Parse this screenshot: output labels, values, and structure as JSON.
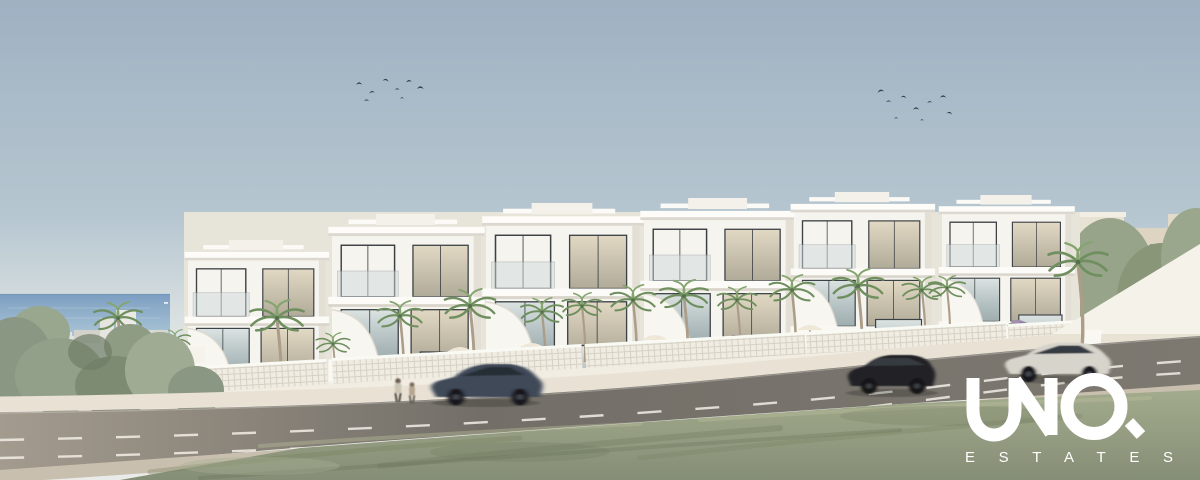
{
  "logo": {
    "brand": "UNIQ",
    "tagline": "ESTATES",
    "color": "#ffffff"
  },
  "palette": {
    "sky_top": "#9fb1c2",
    "sky_horizon": "#e9ebe8",
    "sea": "#7c9ec1",
    "building_white": "#f6f4ef",
    "facade_shadow": "#e3dfd5",
    "glass": "#b9c5c6",
    "fence_lattice": "#f0ece2",
    "road": "#75716a",
    "road_marking": "#f2efe7",
    "sidewalk": "#e9e2d4",
    "grass": "#97a083",
    "tree_green": "#8e9c82",
    "palm_frond": "#6f8f5f",
    "palm_trunk": "#ab9d87",
    "bird": "#323c46",
    "car_moving_dark": "#3f4a58",
    "car_suv_black": "#202428",
    "car_silver": "#d7d4cc",
    "car_parked_blue": "#4a55a0"
  },
  "scene": {
    "description": "Sunny coastal architectural rendering: a stepped row of modern white townhouses with roof pergolas and glass facades, palm trees and breeze-block fences along a two-lane downhill road, sea at the left horizon, old town at right, two flocks of birds, passing cars and two pedestrians; white UNIQ ESTATES watermark at lower right.",
    "townhouse_blocks": 6,
    "palm_trees": 16,
    "moving_cars": 3,
    "parked_cars": 1,
    "pedestrians": 2,
    "bird_flocks": 2
  }
}
